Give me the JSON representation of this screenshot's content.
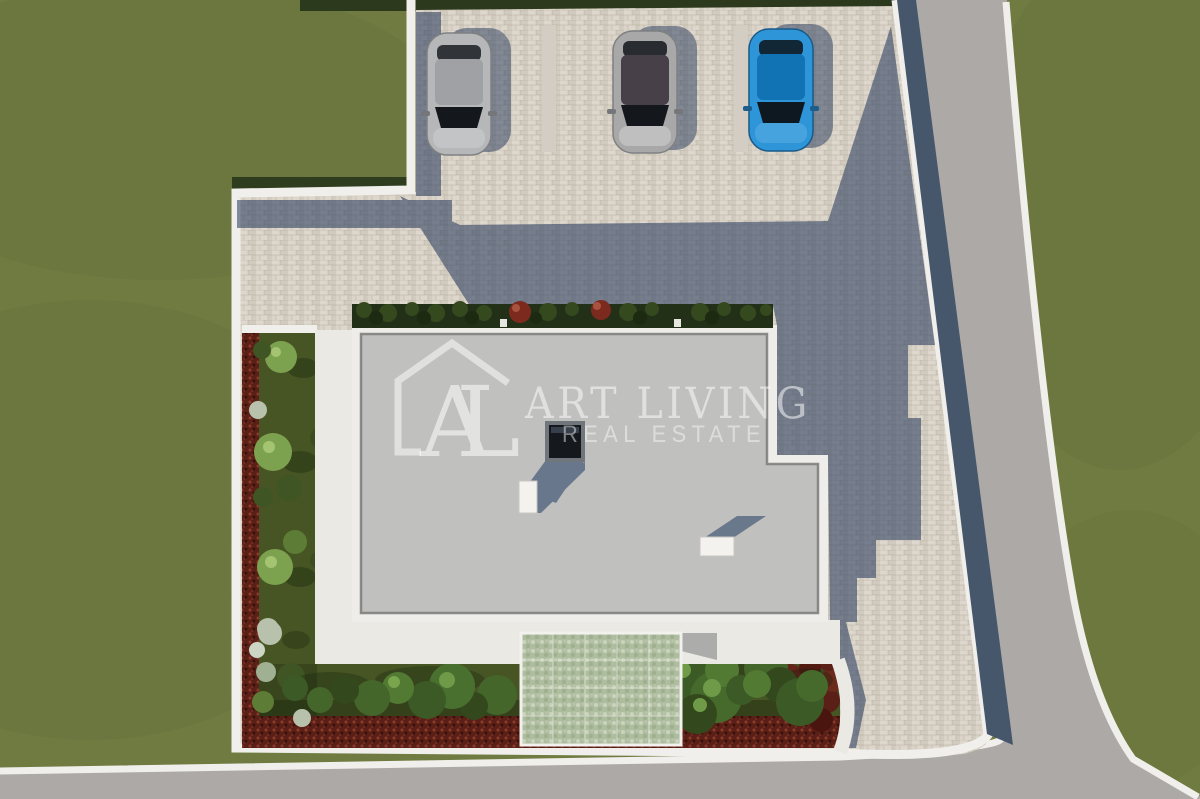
{
  "watermark": {
    "logo_letters": "AL",
    "title": "ART LIVING",
    "subtitle": "REAL ESTATE"
  },
  "scene": {
    "type": "aerial-3d-real-estate-rendering",
    "cars": [
      {
        "name": "silver-car",
        "body": "#b5b7b9",
        "roof": "#9fa1a4",
        "hood": "#c2c4c6"
      },
      {
        "name": "gray-car",
        "body": "#a9a8a8",
        "roof": "#474049",
        "hood": "#c0bfbf"
      },
      {
        "name": "blue-car",
        "body": "#2e95d8",
        "roof": "#1273b4",
        "hood": "#47a3dd"
      }
    ]
  },
  "colors": {
    "lawn": "#78883e",
    "garden": "#58692d",
    "hedge_red": "#5a1f16",
    "hedge_green": "#233018",
    "pavers": "#e8e0d3",
    "stripe": "#d3cdc3",
    "road": "#b6b3b1",
    "curb": "#f1efeb",
    "wall": "#46566b",
    "shadow": "#26395c",
    "roof": "#c9c9c7",
    "parapet": "#efede9",
    "walkway": "#ebe9e4",
    "skylight": "#15191e",
    "watermark": "#ffffff"
  }
}
